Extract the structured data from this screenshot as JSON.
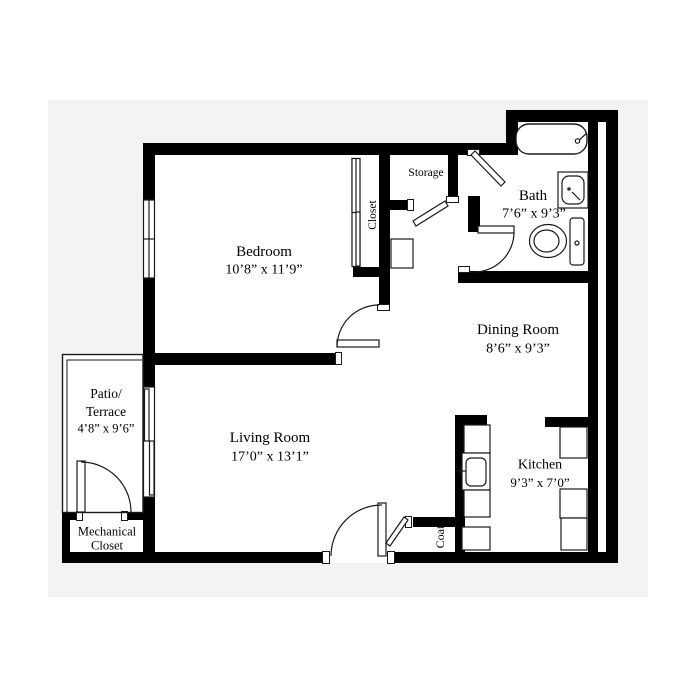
{
  "plan": {
    "type": "apartment-floor-plan",
    "colors": {
      "wall": "#000000",
      "background": "#ffffff",
      "backdrop": "#f3f3f3",
      "line": "#1a1a1a"
    },
    "rooms": [
      {
        "name": "Bedroom",
        "dims": "10’8” x 11’9”"
      },
      {
        "name": "Bath",
        "dims": "7’6” x 9’3”"
      },
      {
        "name": "Dining Room",
        "dims": "8’6” x 9’3”"
      },
      {
        "name": "Living Room",
        "dims": "17’0” x 13’1”"
      },
      {
        "name": "Kitchen",
        "dims": "9’3” x 7’0”"
      },
      {
        "name": "Patio/Terrace",
        "line1": "Patio/",
        "line2": "Terrace",
        "dims": "4’8” x 9’6”"
      },
      {
        "name": "Mechanical Closet",
        "line1": "Mechanical",
        "line2": "Closet"
      }
    ],
    "closet_labels": {
      "storage": "Storage",
      "bedroom_closet": "Closet",
      "coat": "Coat"
    },
    "fixtures": [
      "bathtub",
      "bathroom-sink",
      "toilet",
      "kitchen-sink",
      "kitchen-counters",
      "closet-shelf"
    ]
  }
}
